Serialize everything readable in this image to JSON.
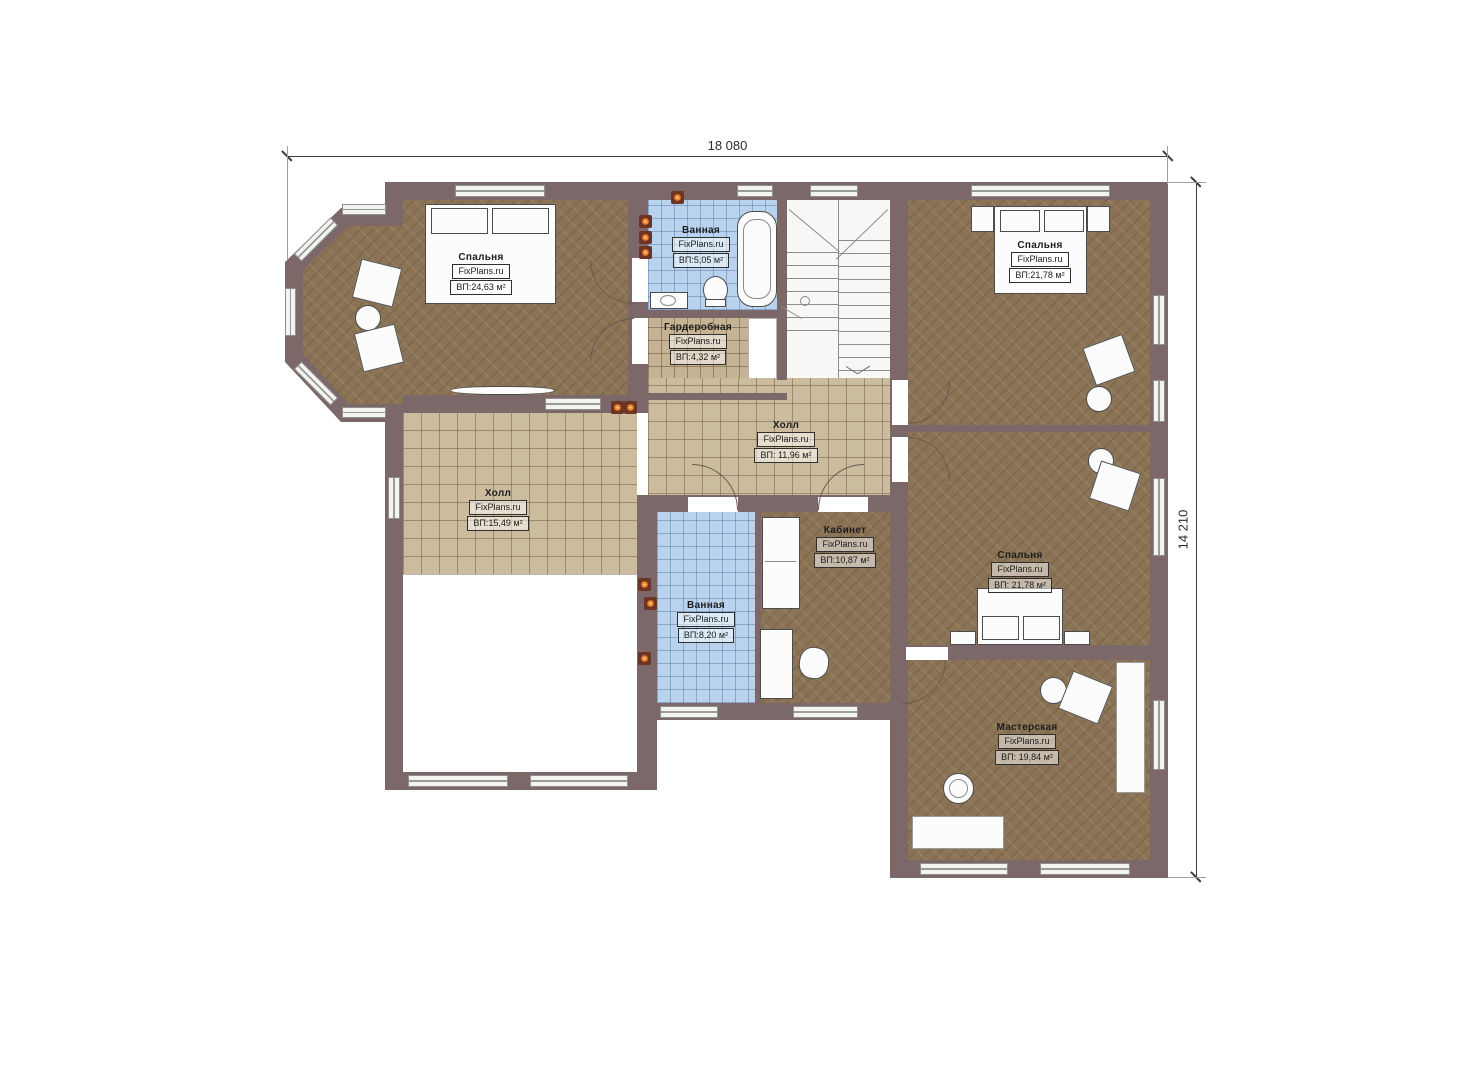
{
  "dimensions": {
    "top": "18 080",
    "right": "14 210"
  },
  "rooms": [
    {
      "id": "bedroom-top-left",
      "name": "Спальня",
      "watermark": "FixPlans.ru",
      "area": "ВП:24,63 м²"
    },
    {
      "id": "bathroom-top",
      "name": "Ванная",
      "watermark": "FixPlans.ru",
      "area": "ВП:5,05 м²"
    },
    {
      "id": "wardrobe",
      "name": "Гардеробная",
      "watermark": "FixPlans.ru",
      "area": "ВП:4,32 м²"
    },
    {
      "id": "bedroom-top-right",
      "name": "Спальня",
      "watermark": "FixPlans.ru",
      "area": "ВП:21,78 м²"
    },
    {
      "id": "hall-center",
      "name": "Холл",
      "watermark": "FixPlans.ru",
      "area": "ВП: 11,96 м²"
    },
    {
      "id": "hall-left",
      "name": "Холл",
      "watermark": "FixPlans.ru",
      "area": "ВП:15,49 м²"
    },
    {
      "id": "office",
      "name": "Кабинет",
      "watermark": "FixPlans.ru",
      "area": "ВП:10,87 м²"
    },
    {
      "id": "bathroom-middle",
      "name": "Ванная",
      "watermark": "FixPlans.ru",
      "area": "ВП:8,20 м²"
    },
    {
      "id": "bedroom-mid-right",
      "name": "Спальня",
      "watermark": "FixPlans.ru",
      "area": "ВП: 21,78 м²"
    },
    {
      "id": "workshop",
      "name": "Мастерская",
      "watermark": "FixPlans.ru",
      "area": "ВП: 19,84 м²"
    }
  ]
}
